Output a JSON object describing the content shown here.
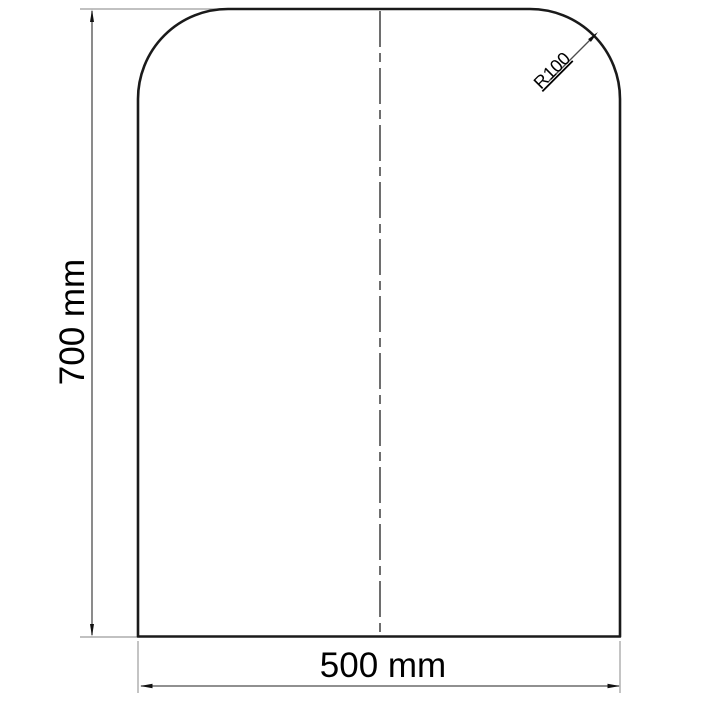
{
  "drawing": {
    "labels": {
      "height": "700 mm",
      "width": "500 mm",
      "corner_radius": "R100"
    },
    "dimensions": {
      "height_mm": 700,
      "width_mm": 500,
      "corner_radius_mm": 100
    },
    "colors": {
      "background": "#ffffff",
      "outline": "#1a1a1a",
      "dimension_line": "#4d4d4d",
      "extension_line": "#9c9c9c",
      "centerline": "#6e6e6e",
      "text": "#000000"
    }
  }
}
